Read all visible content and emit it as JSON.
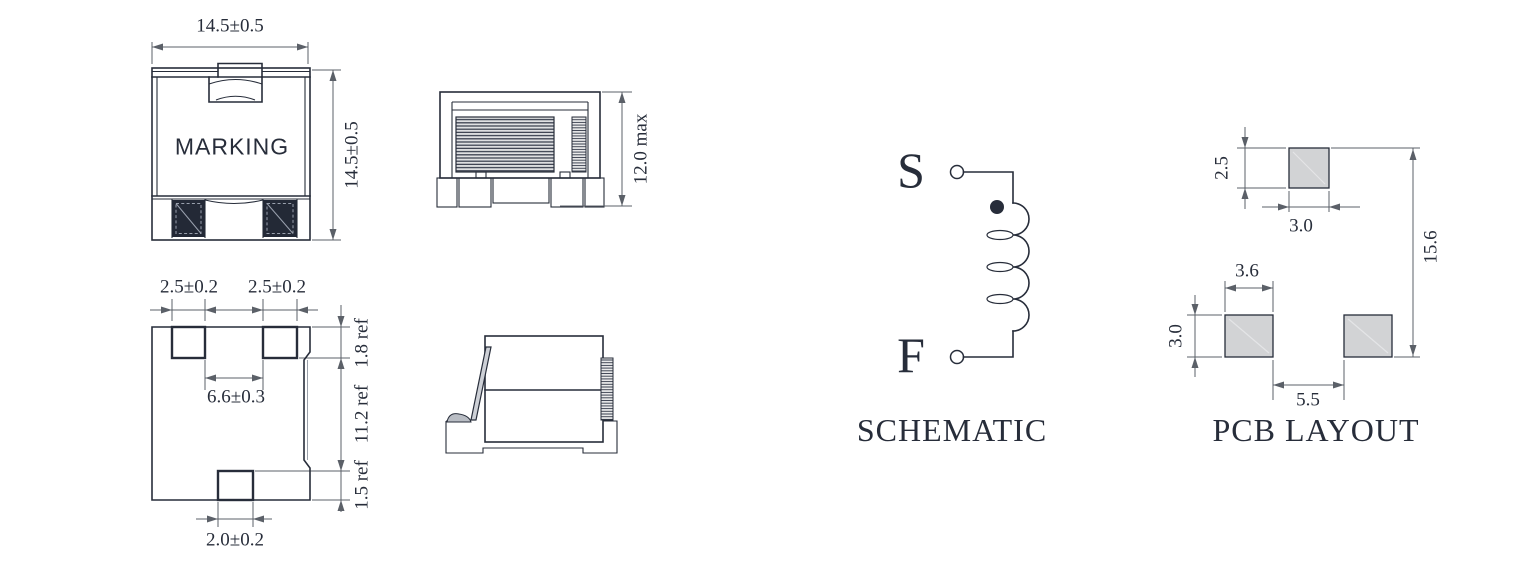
{
  "front_view": {
    "marking": "MARKING",
    "width_dim": "14.5±0.5",
    "height_dim": "14.5±0.5"
  },
  "bottom_view": {
    "pad_width_left": "2.5±0.2",
    "pad_width_right": "2.5±0.2",
    "pad_spacing": "6.6±0.3",
    "bottom_pad_width": "2.0±0.2",
    "ref_pad_depth": "1.8 ref",
    "ref_body": "11.2 ref",
    "ref_bottom_pad": "1.5 ref"
  },
  "side_view": {
    "height_max": "12.0 max"
  },
  "schematic": {
    "title": "SCHEMATIC",
    "start_label": "S",
    "finish_label": "F"
  },
  "pcb_layout": {
    "title": "PCB LAYOUT",
    "top_pad_height": "2.5",
    "top_pad_width": "3.0",
    "side_pad_width": "3.6",
    "side_pad_height": "3.0",
    "pad_gap": "5.5",
    "overall_height": "15.6"
  },
  "colors": {
    "line": "#272d3a",
    "dimension": "#5b6068",
    "pad_fill": "#d2d3d5",
    "dark_pad": "#232936",
    "background": "#ffffff"
  }
}
